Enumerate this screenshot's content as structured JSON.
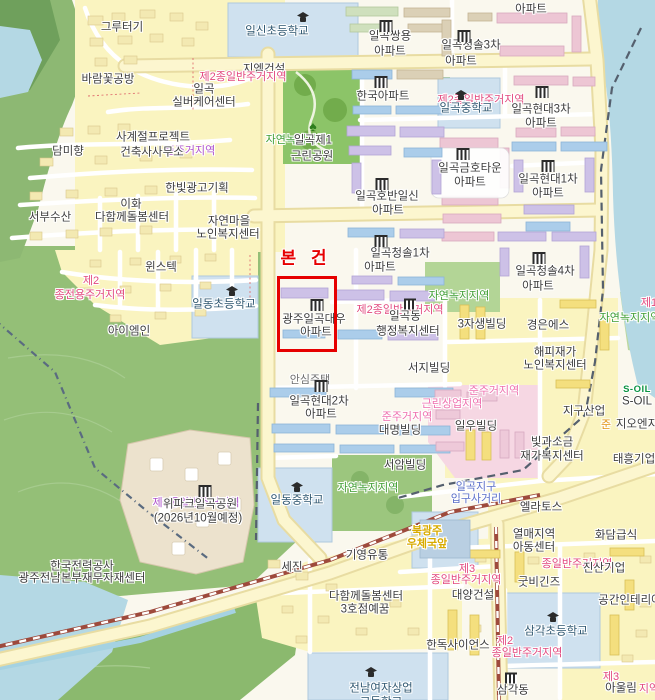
{
  "map": {
    "subject": {
      "label": "본 건",
      "label_pos": {
        "x": 306,
        "y": 259
      },
      "box": {
        "x": 277,
        "y": 276,
        "w": 54,
        "h": 70
      },
      "color": "#e60000",
      "property_name": "광주일곡대우 아파트"
    },
    "zone_colors": {
      "residential_red": "#e2497e",
      "quasi_residential_pink": "#ee6fae",
      "residential_purple": "#ae52cc",
      "green_belt": "#3f9e33",
      "quasi_orange": "#e2920f"
    },
    "labels": [
      {
        "t": "그루터기",
        "x": 122,
        "y": 28,
        "c": "poi"
      },
      {
        "t": "일신초등학교",
        "x": 277,
        "y": 32,
        "c": "school"
      },
      {
        "t": "아파트",
        "x": 531,
        "y": 10,
        "c": "poi"
      },
      {
        "t": "일곡쌍용",
        "x": 390,
        "y": 37,
        "c": "poi"
      },
      {
        "t": "아파트",
        "x": 390,
        "y": 52,
        "c": "poi"
      },
      {
        "t": "일곡청솔3차",
        "x": 471,
        "y": 46,
        "c": "poi"
      },
      {
        "t": "아파트",
        "x": 461,
        "y": 62,
        "c": "poi"
      },
      {
        "t": "바람꽃공방",
        "x": 108,
        "y": 80,
        "c": "poi"
      },
      {
        "t": "일곡",
        "x": 204,
        "y": 90,
        "c": "poi"
      },
      {
        "t": "실버케어센터",
        "x": 204,
        "y": 103,
        "c": "poi"
      },
      {
        "t": "지엠건설",
        "x": 264,
        "y": 70,
        "c": "poi"
      },
      {
        "t": "제2종일반주거지역",
        "x": 243,
        "y": 77,
        "c": "zone-red"
      },
      {
        "t": "한국아파트",
        "x": 383,
        "y": 97,
        "c": "poi"
      },
      {
        "t": "제2종일반주거지역",
        "x": 481,
        "y": 100,
        "c": "zone-red"
      },
      {
        "t": "일곡중학교",
        "x": 466,
        "y": 109,
        "c": "school"
      },
      {
        "t": "일곡현대3차",
        "x": 541,
        "y": 110,
        "c": "poi"
      },
      {
        "t": "아파트",
        "x": 541,
        "y": 124,
        "c": "poi"
      },
      {
        "t": "사계절프로젝트",
        "x": 153,
        "y": 138,
        "c": "poi"
      },
      {
        "t": "준주거지역",
        "x": 190,
        "y": 151,
        "c": "zone-purple"
      },
      {
        "t": "건축사사무소",
        "x": 152,
        "y": 153,
        "c": "poi"
      },
      {
        "t": "담미향",
        "x": 68,
        "y": 152,
        "c": "poi"
      },
      {
        "t": "자연녹지지역",
        "x": 296,
        "y": 140,
        "c": "zone-green"
      },
      {
        "t": "일곡제1",
        "x": 313,
        "y": 141,
        "c": "poi"
      },
      {
        "t": "근린공원",
        "x": 312,
        "y": 157,
        "c": "poi"
      },
      {
        "t": "한빛광고기획",
        "x": 197,
        "y": 189,
        "c": "poi"
      },
      {
        "t": "이화",
        "x": 131,
        "y": 205,
        "c": "poi"
      },
      {
        "t": "다함께돌봄센터",
        "x": 132,
        "y": 218,
        "c": "poi"
      },
      {
        "t": "서부수산",
        "x": 50,
        "y": 218,
        "c": "poi"
      },
      {
        "t": "자연마을",
        "x": 229,
        "y": 222,
        "c": "poi"
      },
      {
        "t": "노인복지센터",
        "x": 228,
        "y": 235,
        "c": "poi"
      },
      {
        "t": "일곡호반일신",
        "x": 387,
        "y": 197,
        "c": "poi"
      },
      {
        "t": "아파트",
        "x": 388,
        "y": 211,
        "c": "poi"
      },
      {
        "t": "일곡금호타운",
        "x": 470,
        "y": 169,
        "c": "poi"
      },
      {
        "t": "아파트",
        "x": 470,
        "y": 183,
        "c": "poi"
      },
      {
        "t": "일곡현대1차",
        "x": 548,
        "y": 180,
        "c": "poi"
      },
      {
        "t": "아파트",
        "x": 548,
        "y": 194,
        "c": "poi"
      },
      {
        "t": "윈스텍",
        "x": 161,
        "y": 268,
        "c": "poi"
      },
      {
        "t": "제2",
        "x": 91,
        "y": 281,
        "c": "zone-red"
      },
      {
        "t": "종전용주거지역",
        "x": 90,
        "y": 295,
        "c": "zone-red"
      },
      {
        "t": "일곡청솔1차",
        "x": 400,
        "y": 254,
        "c": "poi"
      },
      {
        "t": "아파트",
        "x": 380,
        "y": 268,
        "c": "poi"
      },
      {
        "t": "일동초등학교",
        "x": 224,
        "y": 305,
        "c": "school"
      },
      {
        "t": "아이엠인",
        "x": 129,
        "y": 332,
        "c": "poi"
      },
      {
        "t": "광주일곡대우",
        "x": 314,
        "y": 320,
        "c": "poi"
      },
      {
        "t": "아파트",
        "x": 316,
        "y": 333,
        "c": "poi"
      },
      {
        "t": "일곡청솔4차",
        "x": 545,
        "y": 272,
        "c": "poi"
      },
      {
        "t": "아파트",
        "x": 538,
        "y": 287,
        "c": "poi"
      },
      {
        "t": "자연녹지지역",
        "x": 459,
        "y": 296,
        "c": "zone-green"
      },
      {
        "t": "자연녹지지역",
        "x": 630,
        "y": 318,
        "c": "zone-green"
      },
      {
        "t": "제1",
        "x": 649,
        "y": 303,
        "c": "zone-red"
      },
      {
        "t": "제2종일반주거지역",
        "x": 400,
        "y": 310,
        "c": "zone-red"
      },
      {
        "t": "일곡동",
        "x": 405,
        "y": 317,
        "c": "poi"
      },
      {
        "t": "행정복지센터",
        "x": 408,
        "y": 332,
        "c": "poi"
      },
      {
        "t": "3자생빌딩",
        "x": 482,
        "y": 325,
        "c": "poi"
      },
      {
        "t": "경은에스",
        "x": 548,
        "y": 326,
        "c": "poi"
      },
      {
        "t": "해피재가",
        "x": 555,
        "y": 353,
        "c": "poi"
      },
      {
        "t": "노인복지센터",
        "x": 555,
        "y": 366,
        "c": "poi"
      },
      {
        "t": "서지빌딩",
        "x": 429,
        "y": 369,
        "c": "poi"
      },
      {
        "t": "안심주택",
        "x": 310,
        "y": 380,
        "c": "poi-sub"
      },
      {
        "t": "준주거지역",
        "x": 494,
        "y": 391,
        "c": "zone-pink"
      },
      {
        "t": "근린상업지역",
        "x": 452,
        "y": 404,
        "c": "zone-pink"
      },
      {
        "t": "준주거지역",
        "x": 407,
        "y": 417,
        "c": "zone-pink"
      },
      {
        "t": "일곡현대2차",
        "x": 319,
        "y": 402,
        "c": "poi"
      },
      {
        "t": "아파트",
        "x": 321,
        "y": 415,
        "c": "poi"
      },
      {
        "t": "대명빌딩",
        "x": 400,
        "y": 431,
        "c": "poi"
      },
      {
        "t": "일우빌딩",
        "x": 476,
        "y": 427,
        "c": "poi"
      },
      {
        "t": "지구산업",
        "x": 584,
        "y": 412,
        "c": "poi"
      },
      {
        "t": "S-OIL",
        "x": 637,
        "y": 390,
        "c": "soil-logo"
      },
      {
        "t": "S-OIL",
        "x": 637,
        "y": 402,
        "c": "poi"
      },
      {
        "t": "준",
        "x": 606,
        "y": 425,
        "c": "zone-orange"
      },
      {
        "t": "지오엔지",
        "x": 637,
        "y": 425,
        "c": "poi"
      },
      {
        "t": "빛과소금",
        "x": 552,
        "y": 443,
        "c": "poi"
      },
      {
        "t": "재가복지센터",
        "x": 552,
        "y": 457,
        "c": "poi"
      },
      {
        "t": "태흥기업",
        "x": 634,
        "y": 460,
        "c": "poi"
      },
      {
        "t": "서암빌딩",
        "x": 405,
        "y": 466,
        "c": "poi"
      },
      {
        "t": "자연녹지지역",
        "x": 368,
        "y": 488,
        "c": "zone-green"
      },
      {
        "t": "제3종일반주거지역",
        "x": 196,
        "y": 503,
        "c": "zone-purple"
      },
      {
        "t": "위파크일곡공원",
        "x": 200,
        "y": 505,
        "c": "poi"
      },
      {
        "t": "(2026년10월예정)",
        "x": 198,
        "y": 519,
        "c": "poi"
      },
      {
        "t": "일동중학교",
        "x": 297,
        "y": 501,
        "c": "school"
      },
      {
        "t": "일곡지구",
        "x": 476,
        "y": 487,
        "c": "junction"
      },
      {
        "t": "입구사거리",
        "x": 476,
        "y": 499,
        "c": "junction"
      },
      {
        "t": "엘라토스",
        "x": 541,
        "y": 508,
        "c": "poi"
      },
      {
        "t": "북광주",
        "x": 427,
        "y": 531,
        "c": "busstop"
      },
      {
        "t": "우체국앞",
        "x": 427,
        "y": 544,
        "c": "busstop"
      },
      {
        "t": "열매지역",
        "x": 534,
        "y": 535,
        "c": "poi"
      },
      {
        "t": "아동센터",
        "x": 534,
        "y": 548,
        "c": "poi"
      },
      {
        "t": "화담급식",
        "x": 616,
        "y": 536,
        "c": "poi"
      },
      {
        "t": "한국전력공사",
        "x": 82,
        "y": 567,
        "c": "poi"
      },
      {
        "t": "광주전남본부재무자재센터",
        "x": 82,
        "y": 579,
        "c": "poi"
      },
      {
        "t": "기영유통",
        "x": 367,
        "y": 556,
        "c": "poi"
      },
      {
        "t": "세진",
        "x": 292,
        "y": 568,
        "c": "poi"
      },
      {
        "t": "종일반주거지역",
        "x": 577,
        "y": 564,
        "c": "zone-red"
      },
      {
        "t": "제3",
        "x": 467,
        "y": 569,
        "c": "zone-red"
      },
      {
        "t": "종일반주거지역",
        "x": 466,
        "y": 580,
        "c": "zone-red"
      },
      {
        "t": "진산기업",
        "x": 604,
        "y": 569,
        "c": "poi"
      },
      {
        "t": "굿비긴즈",
        "x": 539,
        "y": 583,
        "c": "poi"
      },
      {
        "t": "대양건설",
        "x": 473,
        "y": 596,
        "c": "poi"
      },
      {
        "t": "다함께돌봄센터",
        "x": 366,
        "y": 597,
        "c": "poi"
      },
      {
        "t": "3호점예꿈",
        "x": 365,
        "y": 610,
        "c": "poi"
      },
      {
        "t": "공간인테리어",
        "x": 630,
        "y": 601,
        "c": "poi"
      },
      {
        "t": "제2",
        "x": 505,
        "y": 641,
        "c": "zone-red"
      },
      {
        "t": "종일반주거지역",
        "x": 527,
        "y": 653,
        "c": "zone-red"
      },
      {
        "t": "삼각초등학교",
        "x": 556,
        "y": 632,
        "c": "school"
      },
      {
        "t": "한독사이언스",
        "x": 458,
        "y": 646,
        "c": "poi"
      },
      {
        "t": "제3",
        "x": 611,
        "y": 677,
        "c": "zone-red"
      },
      {
        "t": "아울림",
        "x": 621,
        "y": 689,
        "c": "poi"
      },
      {
        "t": "지역",
        "x": 649,
        "y": 689,
        "c": "zone-red"
      },
      {
        "t": "삼각동",
        "x": 513,
        "y": 691,
        "c": "poi"
      },
      {
        "t": "전남여자상업",
        "x": 381,
        "y": 689,
        "c": "school"
      },
      {
        "t": "고등학교",
        "x": 381,
        "y": 703,
        "c": "school"
      }
    ],
    "icons": [
      {
        "k": "school",
        "x": 303,
        "y": 17
      },
      {
        "k": "apt",
        "x": 386,
        "y": 26
      },
      {
        "k": "apt",
        "x": 464,
        "y": 36
      },
      {
        "k": "apt",
        "x": 381,
        "y": 82
      },
      {
        "k": "school",
        "x": 461,
        "y": 95
      },
      {
        "k": "apt",
        "x": 542,
        "y": 92
      },
      {
        "k": "tree",
        "x": 313,
        "y": 126
      },
      {
        "k": "apt",
        "x": 382,
        "y": 184
      },
      {
        "k": "apt",
        "x": 463,
        "y": 154
      },
      {
        "k": "apt",
        "x": 548,
        "y": 166
      },
      {
        "k": "apt",
        "x": 381,
        "y": 241
      },
      {
        "k": "school",
        "x": 232,
        "y": 291
      },
      {
        "k": "apt",
        "x": 317,
        "y": 305
      },
      {
        "k": "apt",
        "x": 539,
        "y": 258
      },
      {
        "k": "gov",
        "x": 410,
        "y": 304
      },
      {
        "k": "apt",
        "x": 321,
        "y": 386
      },
      {
        "k": "apt",
        "x": 205,
        "y": 491
      },
      {
        "k": "school",
        "x": 297,
        "y": 487
      },
      {
        "k": "school",
        "x": 553,
        "y": 617
      },
      {
        "k": "gov",
        "x": 511,
        "y": 678
      },
      {
        "k": "school",
        "x": 371,
        "y": 672
      }
    ]
  }
}
